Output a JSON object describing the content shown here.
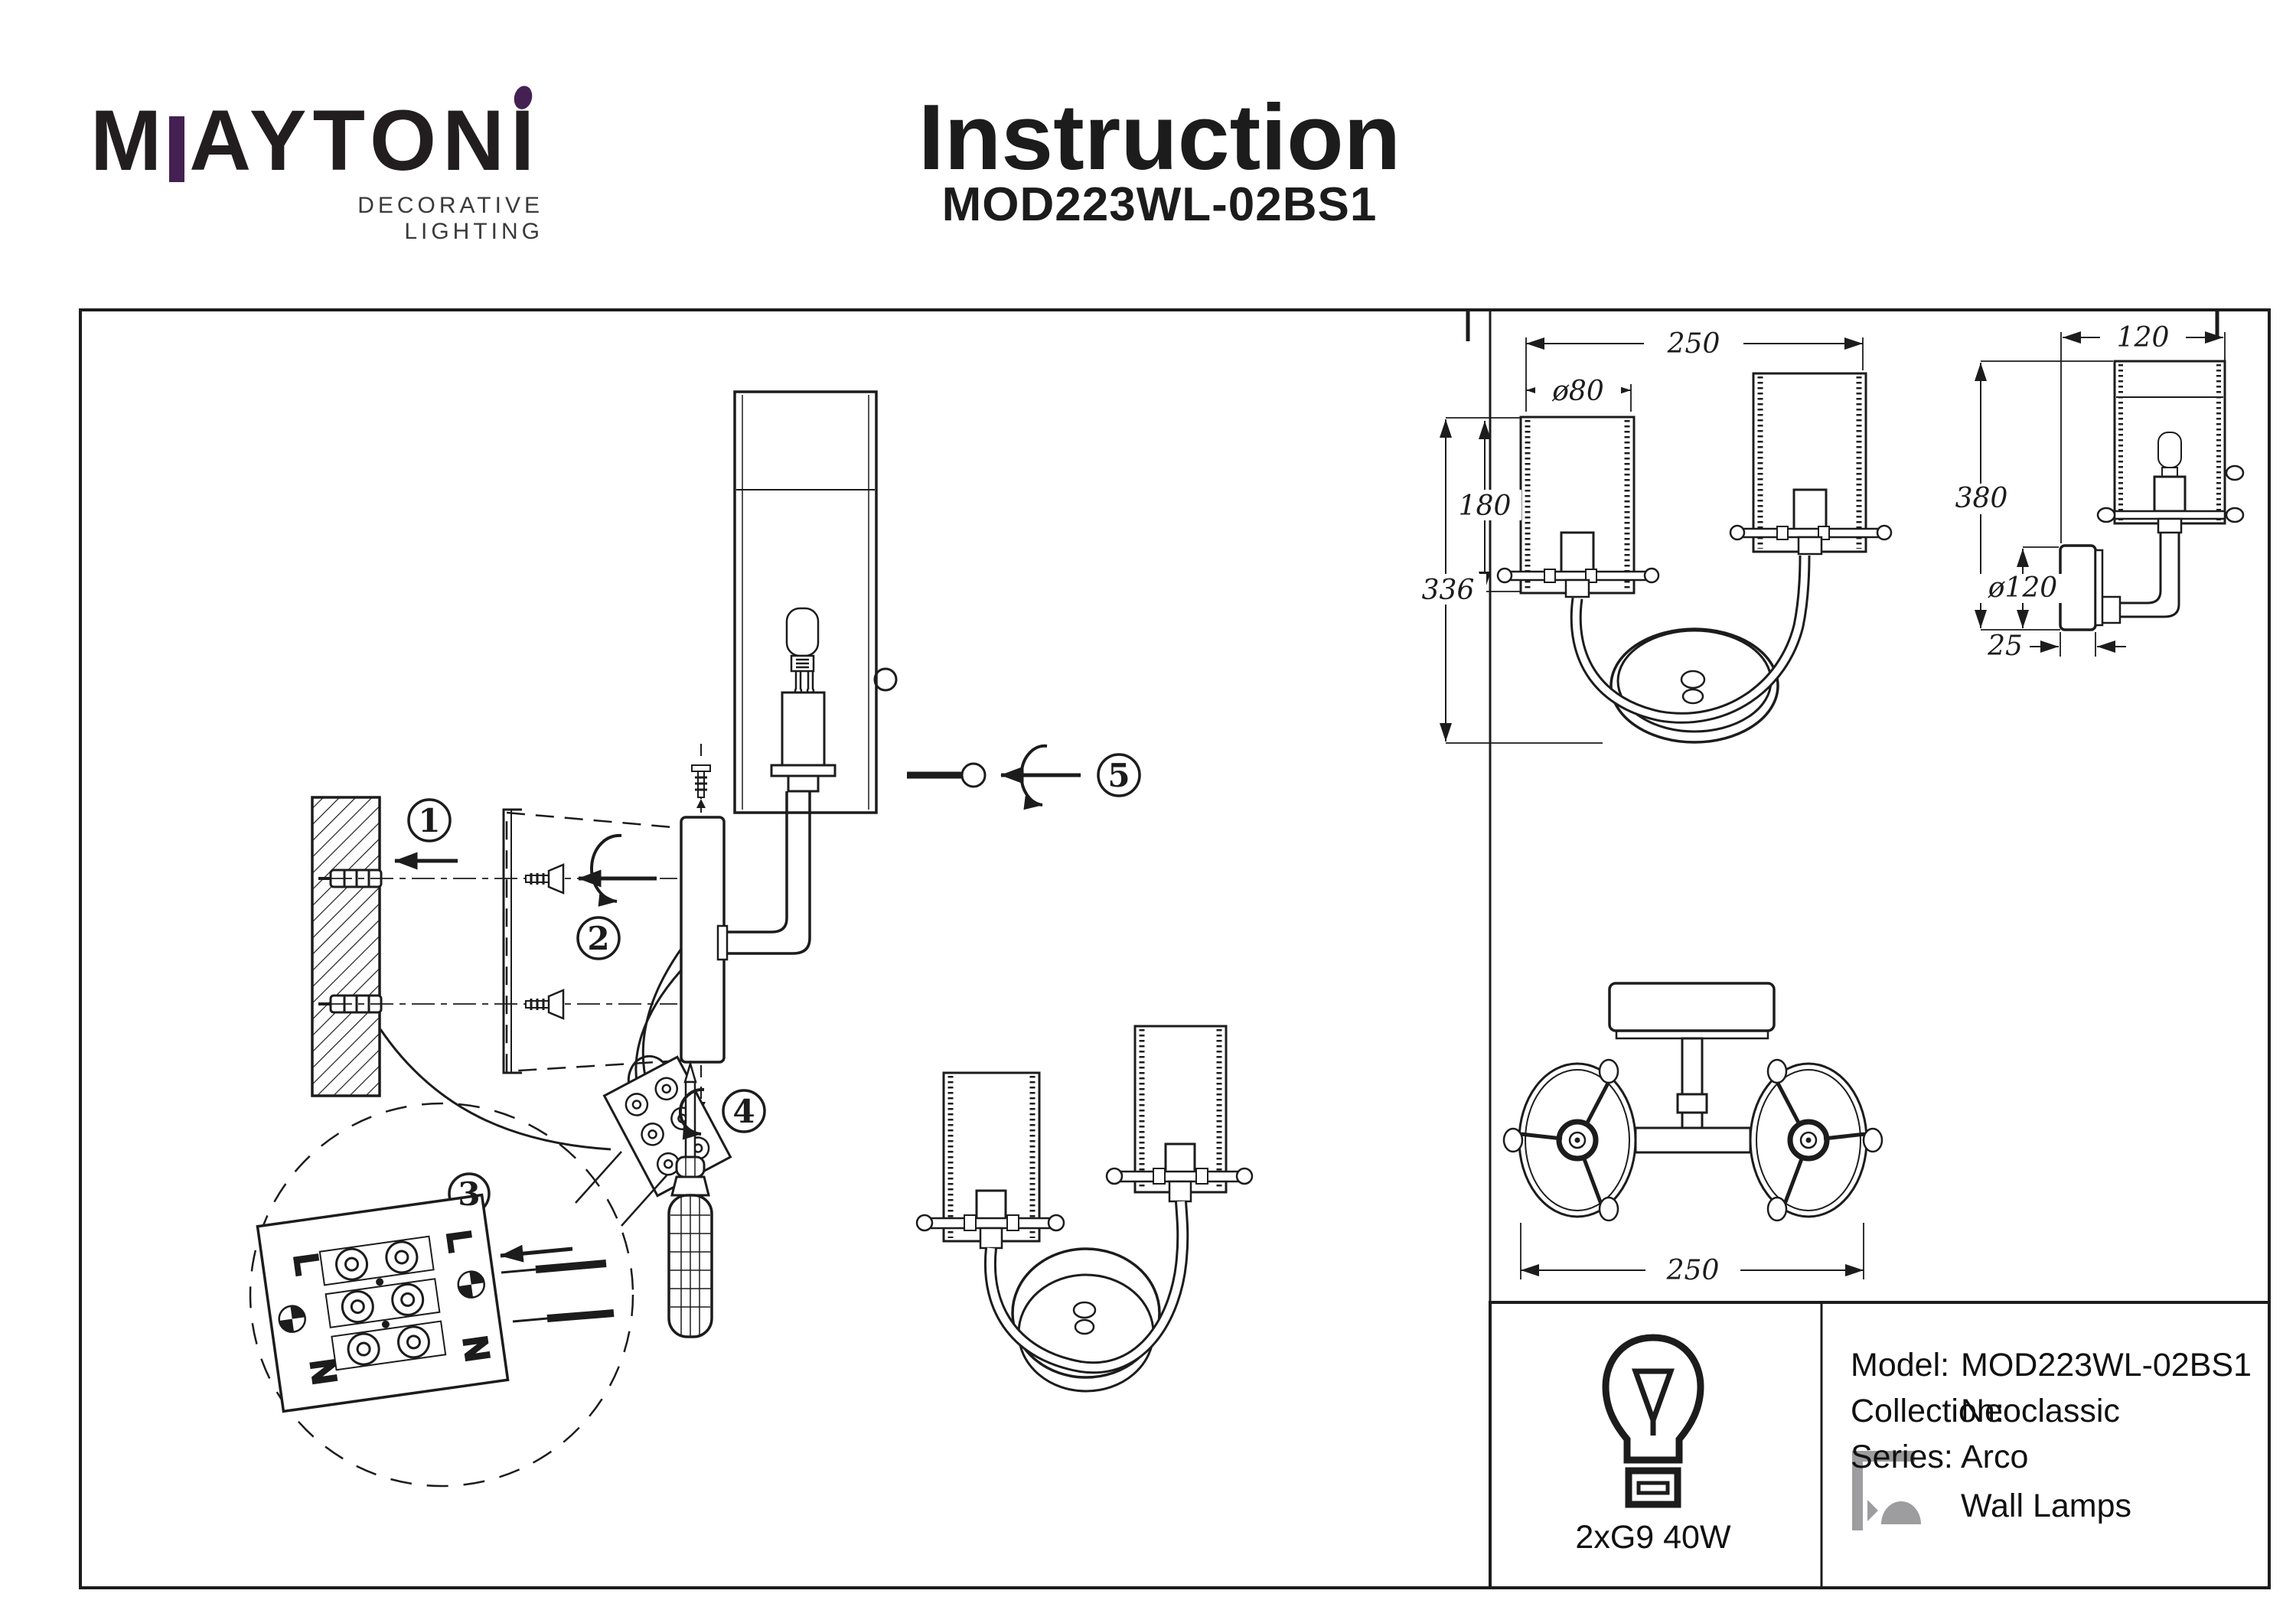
{
  "header": {
    "logo": {
      "word_m": "M",
      "word_rest": "AYTONI",
      "tagline": "DECORATIVE LIGHTING"
    },
    "title": "Instruction",
    "model": "MOD223WL-02BS1"
  },
  "colors": {
    "ink": "#1c1c1c",
    "accent_purple": "#452153",
    "icon_gray": "#9d9da0"
  },
  "steps": {
    "s1": "1",
    "s2": "2",
    "s3": "3",
    "s4": "4",
    "s5": "5"
  },
  "wiring": {
    "live": "L",
    "neutral": "N"
  },
  "dimensions": {
    "front_width": "250",
    "shade_diameter": "ø80",
    "shade_height": "180",
    "fixture_height": "336",
    "side_depth": "120",
    "total_height": "380",
    "plate_diameter": "ø120",
    "plate_thickness": "25",
    "top_width": "250"
  },
  "spec_table": {
    "model_label": "Model:",
    "model_value": "MOD223WL-02BS1",
    "collection_label": "Collection:",
    "collection_value": "Neoclassic",
    "series_label": "Series:",
    "series_value": "Arco",
    "type_value": "Wall Lamps",
    "bulb": "2xG9 40W"
  }
}
